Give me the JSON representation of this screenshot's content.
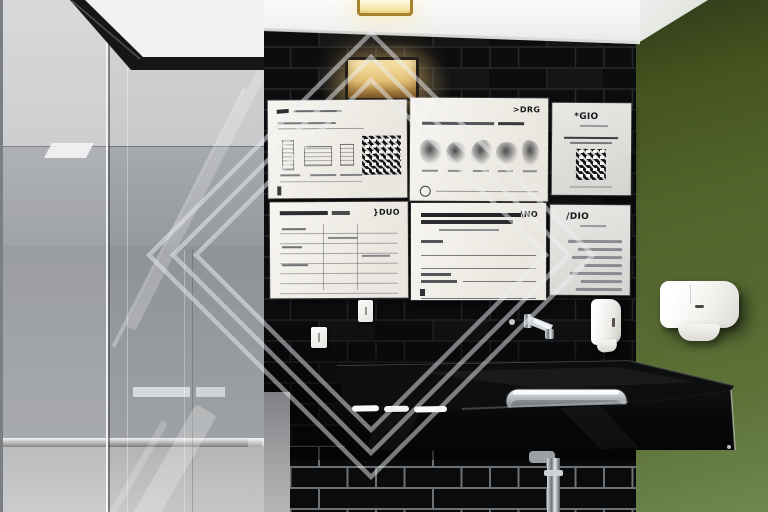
{
  "scene": {
    "type": "photograph",
    "setting": "modern restroom interior",
    "elements": [
      "glass partition",
      "black subway tile wall",
      "six framed informational posters",
      "olive green accent wall",
      "black stone countertop",
      "stainless steel undermount sink",
      "wall mounted faucet",
      "chrome drain pipe",
      "soap dispenser",
      "paper towel dispenser",
      "recessed ceiling light",
      "warm wall sconce",
      "light switch plates",
      "diamond watermark overlay"
    ]
  },
  "palette": {
    "ceiling": "#f2f3f1",
    "glass": "#9aa0a4",
    "tile": "#0c0d0f",
    "grout_bright": "#8d9093",
    "green_wall": "#53652e",
    "poster": "#f2efe8",
    "counter": "#0a0b0c",
    "steel": "#b9bdc0",
    "warm_light": "#f0d896",
    "dispenser": "#f4f3ef"
  },
  "posters": {
    "top_left": {
      "logo": "",
      "features": "handwritten header, three sketches, QR code, caption lines"
    },
    "top_middle": {
      "logo": ">DRG",
      "features": "headline, five sketch icons with captions, circle mark"
    },
    "top_right": {
      "logo": "*GIO",
      "features": "logo, caption line, QR code"
    },
    "bottom_left": {
      "logo": "}DUO",
      "features": "bold title, multi-row data table"
    },
    "bottom_middle": {
      "logo": "\\NO",
      "features": "two-line bold headline, form fields with rules"
    },
    "bottom_right": {
      "logo": "/DIO",
      "features": "logo, right-aligned paragraph lines"
    }
  },
  "watermark": {
    "shape": "three concentric diamond outlines",
    "center_x": 371,
    "center_y": 255,
    "half_sizes": [
      222,
      198,
      175
    ],
    "color": "#eceff2"
  }
}
